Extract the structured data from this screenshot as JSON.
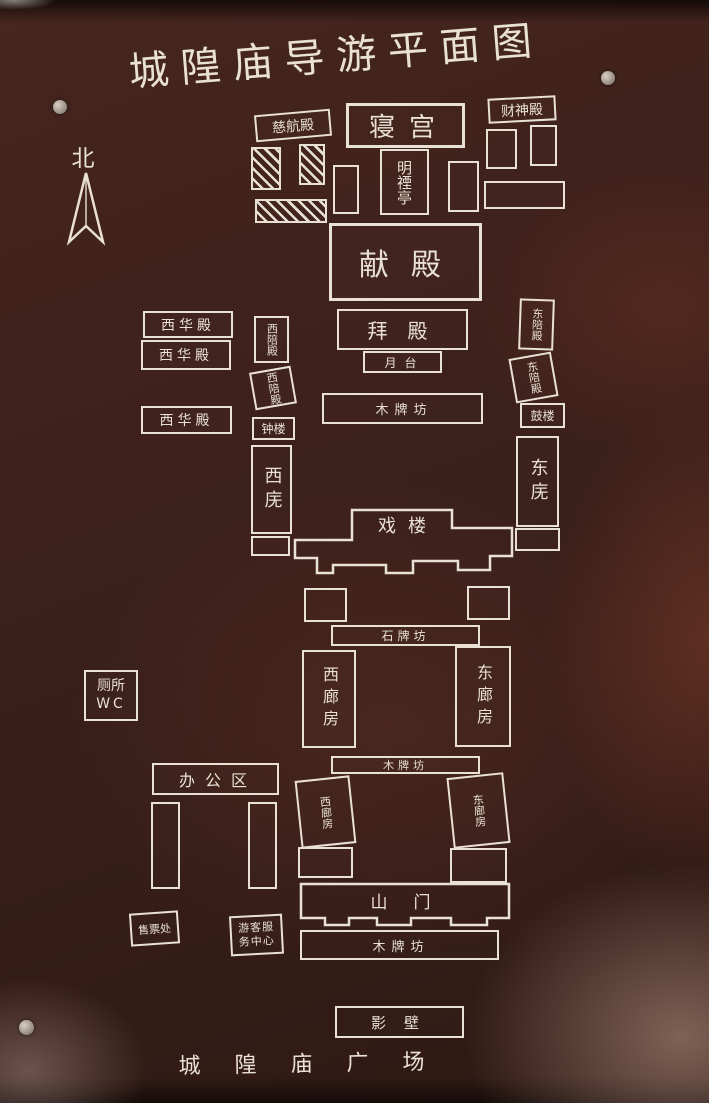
{
  "title": "城隍庙导游平面图",
  "compass_label": "北",
  "plaza_label": "城隍庙广场",
  "labels": {
    "cihangdian": "慈航殿",
    "caishendian": "财神殿",
    "qingong": "寝宫",
    "mingyinting": "明禋亭",
    "xiandian": "献殿",
    "xihuadian": "西华殿",
    "xipeidian": "西陪殿",
    "dongpeidian": "东陪殿",
    "baidian": "拜殿",
    "yuetai": "月台",
    "mupaifang": "木牌坊",
    "shipaifang": "石牌坊",
    "zhonglou": "钟楼",
    "gulou": "鼓楼",
    "xiwu": "西庑",
    "dongwu": "东庑",
    "xilou": "戏楼",
    "xilangfang": "西廊房",
    "donglangfang": "东廊房",
    "cesuo": "厕所",
    "wc": "WC",
    "bangongqu": "办公区",
    "shanmen": "山门",
    "shoupiaochu": "售票处",
    "youkefuwuzhongxin": "游客服务中心",
    "yingbi": "影壁"
  },
  "colors": {
    "board": "#3c211b",
    "line": "#e9e1d3"
  }
}
